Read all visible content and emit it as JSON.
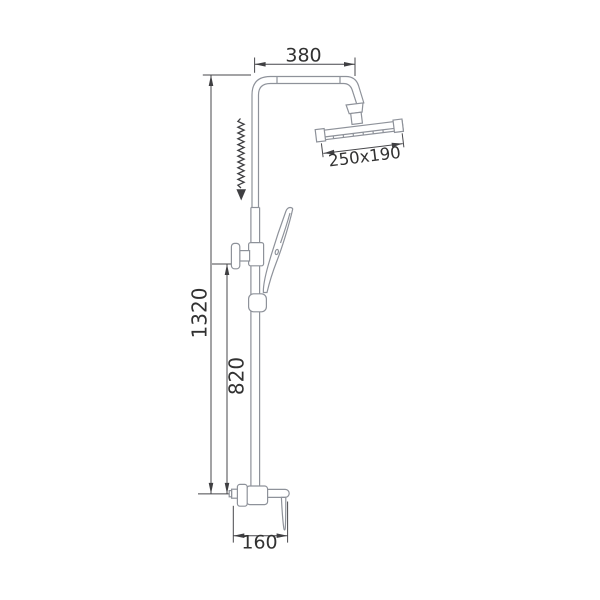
{
  "drawing": {
    "kind": "technical-dimension-drawing",
    "subject": "shower column set with rain head, hand shower and mixer",
    "colors": {
      "background": "#ffffff",
      "product_outline": "#8e929a",
      "dimension_lines": "#47474b",
      "dimension_text": "#323232"
    },
    "dimensions": {
      "top_width": "380",
      "head_size": "250x190",
      "total_height": "1320",
      "bar_height": "820",
      "base_depth": "160"
    }
  }
}
